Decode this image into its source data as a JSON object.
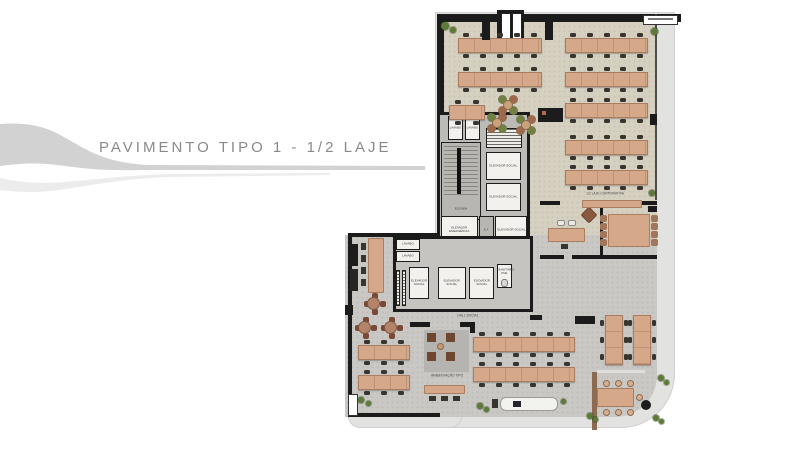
{
  "title": "PAVIMENTO TIPO 1 - 1/2 LAJE",
  "plan": {
    "rooms": {
      "lavabo": "LAVABO",
      "escada": "ESCADA",
      "elevador_social": "ELEVADOR SOCIAL",
      "elevador_emergencia": "ELEVADOR EMERGÊNCIA",
      "at": "A.T.",
      "hall_elevadores": "HALL ELEVADORES",
      "hall_social": "HALL SOCIAL",
      "sanitario_pne": "SANITÁRIO PNE"
    },
    "annotations": {
      "corporativa": "1/2 LAJE CORPORATIVA",
      "ambientacao": "AMBIENTAÇÃO TIPO"
    },
    "colors": {
      "wall": "#1b1b1b",
      "floor_upper": "#d6d0c0",
      "floor_lower": "#c9c8c4",
      "desk": "#d6a88a",
      "chair": "#38352f",
      "plant": "#5d7a38",
      "title_text": "#8a8a8a",
      "facade_band": "#e2e2e1"
    }
  }
}
